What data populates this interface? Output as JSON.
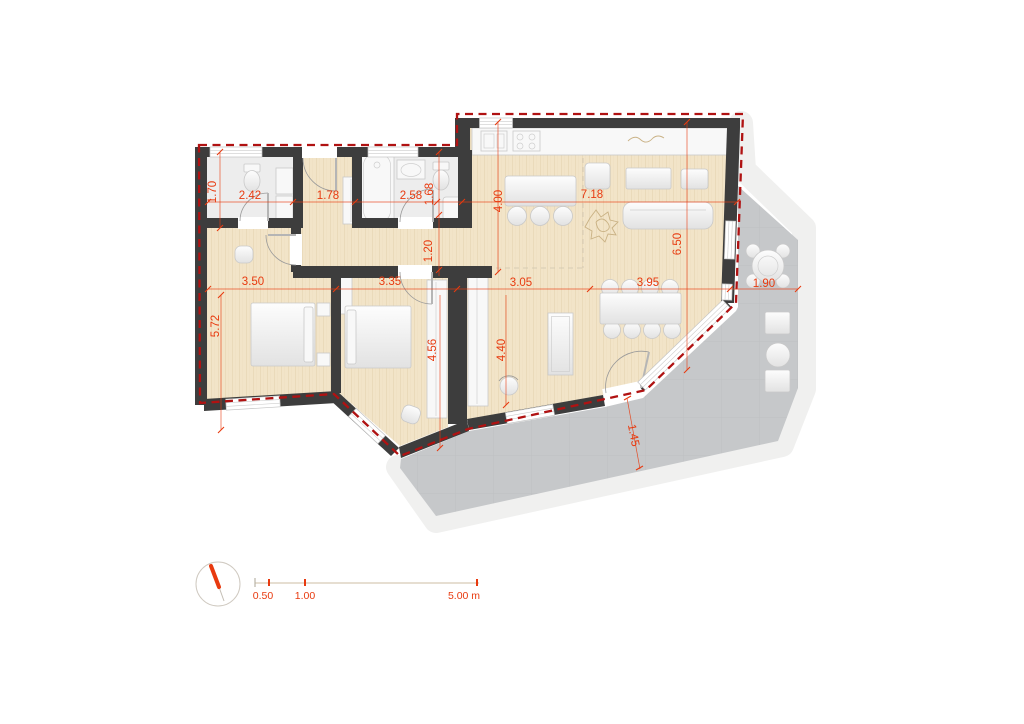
{
  "colors": {
    "wall": "#3d3d3d",
    "wood": "#f2e4c8",
    "wood_grain": "#e8d8b7",
    "tile": "#ededed",
    "terrace": "#c6c8ca",
    "terrace_grid": "#bfc1c3",
    "outer_band": "#f0f0ef",
    "dim": "#e83a0f",
    "dash": "#b01212",
    "furnstroke": "#c9c9c9"
  },
  "dims": {
    "wc_depth": "1.70",
    "wc_width": "2.42",
    "entry_width": "1.78",
    "bath_width": "2.58",
    "bath_nook_depth": "1.68",
    "kitchen_depth": "4.00",
    "living_width": "7.18",
    "living_depth": "6.50",
    "hall_width": "1.20",
    "bedroom1_width": "3.50",
    "bedroom2_width": "3.35",
    "study_width": "3.05",
    "dining_width": "3.95",
    "terrace_width": "1.90",
    "bedroom1_depth": "5.72",
    "bedroom2_depth": "4.56",
    "study_depth": "4.40",
    "terrace_depth": "1.45"
  },
  "scale_bar": {
    "tick_small": "0.50",
    "tick_mid": "1.00",
    "tick_end": "5.00 m"
  }
}
